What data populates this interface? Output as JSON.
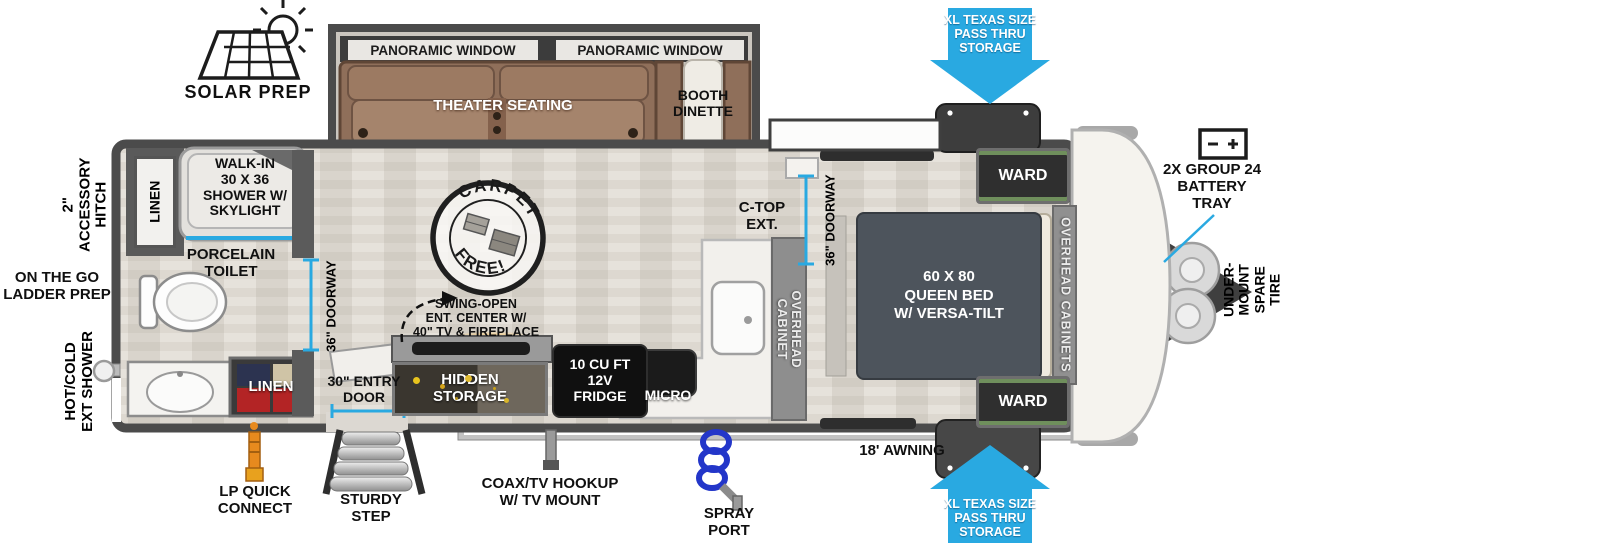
{
  "colors": {
    "accent_blue": "#29a9e1",
    "wall_gray": "#4b4b4b",
    "sofa_brown": "#8f6f5a",
    "bed_gray": "#4d545c",
    "counter_white": "#f2f0ec",
    "appliance_black": "#121212",
    "linen_red": "#b32425",
    "lp_orange": "#e78a1e"
  },
  "top": {
    "solar_prep": "SOLAR PREP",
    "pass_thru_storage": "XL TEXAS SIZE\nPASS THRU\nSTORAGE"
  },
  "slideout": {
    "window_left": "PANORAMIC WINDOW",
    "window_right": "PANORAMIC WINDOW",
    "theater": "THEATER SEATING",
    "dinette": "BOOTH\nDINETTE"
  },
  "left_labels": {
    "accessory_hitch": "2\" ACCESSORY\nHITCH",
    "ladder_prep": "ON THE GO\nLADDER PREP",
    "ext_shower": "HOT/COLD\nEXT SHOWER"
  },
  "bathroom": {
    "linen_top": "LINEN",
    "shower": "WALK-IN\n30 X 36\nSHOWER W/\nSKYLIGHT",
    "toilet": "PORCELAIN\nTOILET",
    "linen_bottom": "LINEN",
    "doorway": "36\" DOORWAY"
  },
  "living": {
    "carpet_top": "CARPET",
    "carpet_bottom": "FREE!",
    "swing_open": "SWING-OPEN\nENT. CENTER W/\n40\" TV & FIREPLACE",
    "hidden_storage": "HIDDEN\nSTORAGE",
    "fridge": "10 CU FT\n12V\nFRIDGE",
    "micro": "MICRO"
  },
  "kitchen": {
    "ctop": "C-TOP\nEXT.",
    "overhead_cabinet": "OVERHEAD\nCABINET"
  },
  "bedroom": {
    "doorway": "36\" DOORWAY",
    "bed": "60 X 80\nQUEEN BED\nW/ VERSA-TILT",
    "ward_top": "WARD",
    "ward_bottom": "WARD",
    "overhead_cabinets": "OVERHEAD CABINETS"
  },
  "front": {
    "battery": "2X GROUP 24\nBATTERY\nTRAY",
    "spare_tire": "UNDER-MOUNT\nSPARE TIRE",
    "pass_thru_storage": "XL TEXAS SIZE\nPASS THRU\nSTORAGE"
  },
  "bottom": {
    "lp": "LP QUICK\nCONNECT",
    "entry_door": "30\" ENTRY\nDOOR",
    "step": "STURDY\nSTEP",
    "coax": "COAX/TV HOOKUP\nW/ TV MOUNT",
    "spray": "SPRAY\nPORT",
    "awning": "18' AWNING"
  }
}
